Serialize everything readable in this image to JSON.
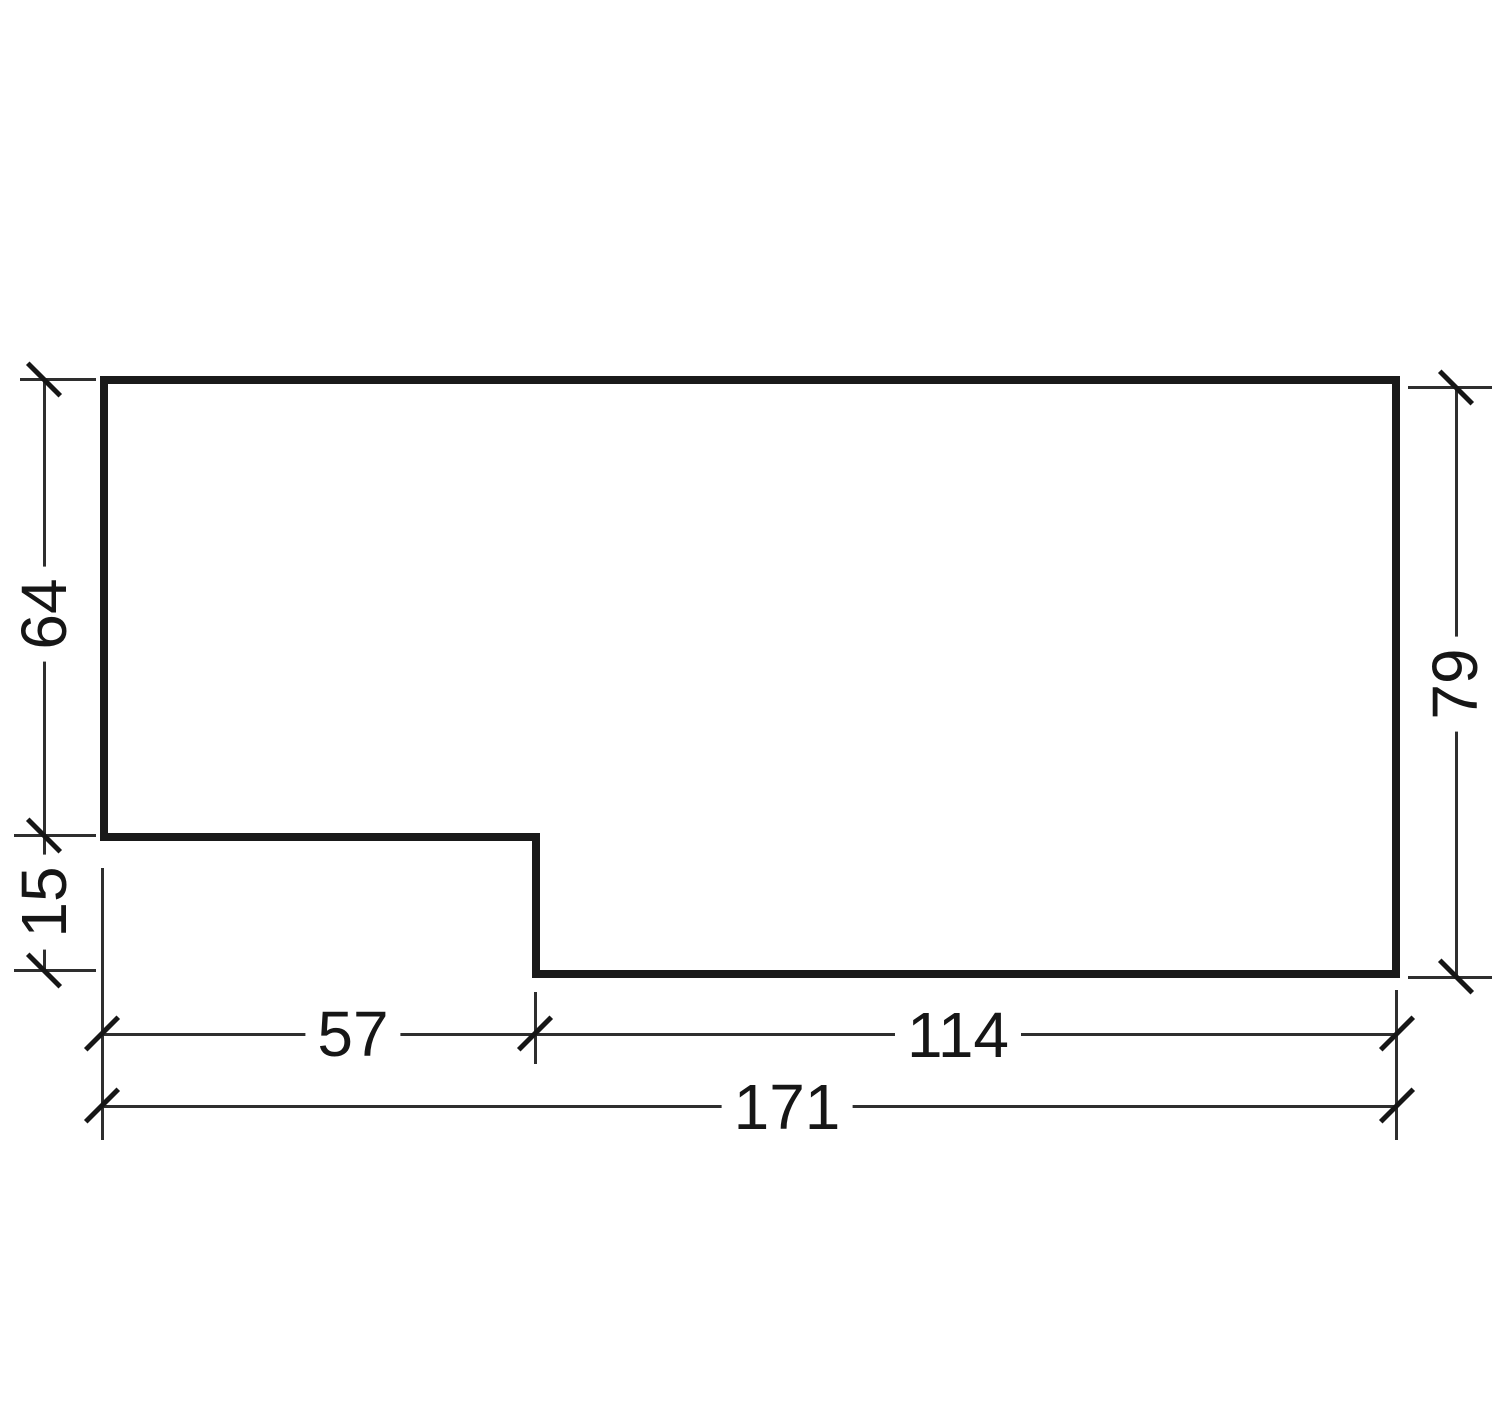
{
  "figure": {
    "type": "dimensioned-outline-drawing",
    "description": "Stepped rectangular profile with architectural dimension lines and oblique ticks",
    "background_color": "#ffffff",
    "ink_color": "#1a1a1a",
    "dimension_line_color": "#2e2e2e"
  },
  "dims": {
    "left_upper": "64",
    "left_lower": "15",
    "right": "79",
    "bottom_left": "57",
    "bottom_right": "114",
    "bottom_total": "171"
  }
}
